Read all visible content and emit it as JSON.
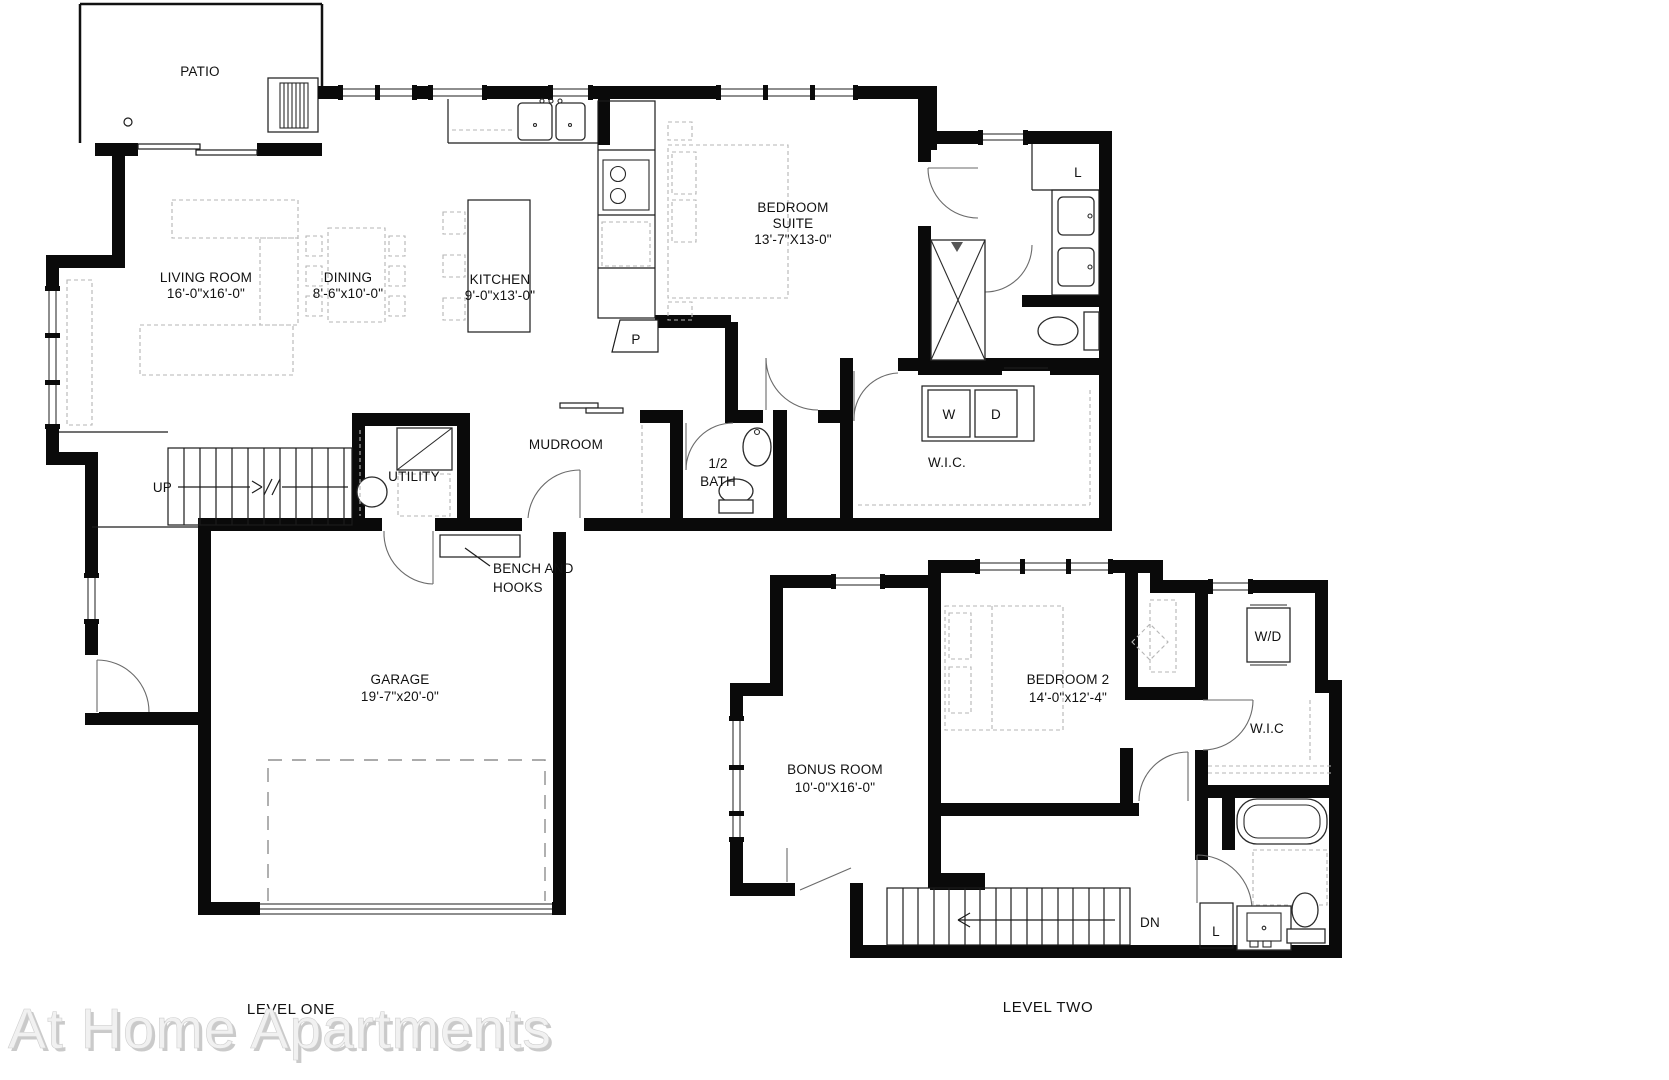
{
  "watermark": "At Home Apartments",
  "levels": {
    "one": {
      "label": "LEVEL ONE",
      "rooms": {
        "patio": {
          "name": "PATIO"
        },
        "living": {
          "name": "LIVING ROOM",
          "dims": "16'-0\"x16'-0\""
        },
        "dining": {
          "name": "DINING",
          "dims": "8'-6\"x10'-0\""
        },
        "kitchen": {
          "name": "KITCHEN",
          "dims": "9'-0\"x13'-0\""
        },
        "suite": {
          "name": "BEDROOM",
          "name2": "SUITE",
          "dims": "13'-7\"X13-0\""
        },
        "mudroom": {
          "name": "MUDROOM"
        },
        "utility": {
          "name": "UTILITY"
        },
        "half_bath": {
          "name": "1/2",
          "name2": "BATH"
        },
        "wic": {
          "name": "W.I.C."
        },
        "garage": {
          "name": "GARAGE",
          "dims": "19'-7\"x20'-0\""
        }
      },
      "labels": {
        "up": "UP",
        "washer": "W",
        "dryer": "D",
        "pantry": "P",
        "linen": "L",
        "bench_line1": "BENCH AND",
        "bench_line2": "HOOKS"
      }
    },
    "two": {
      "label": "LEVEL TWO",
      "rooms": {
        "bonus": {
          "name": "BONUS ROOM",
          "dims": "10'-0\"X16'-0\""
        },
        "bedroom2": {
          "name": "BEDROOM 2",
          "dims": "14'-0\"x12'-4\""
        },
        "wic": {
          "name": "W.I.C"
        }
      },
      "labels": {
        "wd": "W/D",
        "dn": "DN",
        "linen": "L"
      }
    }
  }
}
